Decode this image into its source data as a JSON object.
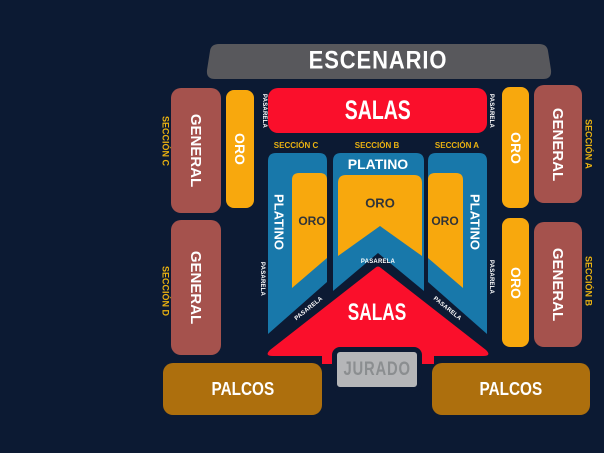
{
  "colors": {
    "background": "#0c1a33",
    "red": "#fa0f2b",
    "blue": "#1878aa",
    "gold": "#f8a80d",
    "maroon": "#a5524d",
    "brown": "#ad6f0d",
    "stage_gray": "#58585c",
    "jurado_gray": "#b5b6b8",
    "jurado_text": "#8b8e90",
    "section_label_gold": "#eab211",
    "oro_text_dark": "#313438",
    "white": "#ffffff"
  },
  "stage": {
    "label": "ESCENARIO"
  },
  "salas_top": {
    "label": "SALAS"
  },
  "section_headers": {
    "left": "SECCIÓN C",
    "center": "SECCIÓN B",
    "right": "SECCIÓN A"
  },
  "left_wing": {
    "general_top": {
      "label": "GENERAL",
      "section": "SECCIÓN C"
    },
    "general_bottom": {
      "label": "GENERAL",
      "section": "SECCIÓN D"
    },
    "oro": {
      "label": "ORO"
    },
    "pasarela_top": "PASARELA",
    "pasarela_bottom": "PASARELA"
  },
  "right_wing": {
    "general_top": {
      "label": "GENERAL",
      "section": "SECCIÓN A"
    },
    "general_bottom": {
      "label": "GENERAL",
      "section": "SECCIÓN B"
    },
    "oro_top": {
      "label": "ORO"
    },
    "oro_bottom": {
      "label": "ORO"
    },
    "pasarela_top": "PASARELA",
    "pasarela_bottom": "PASARELA"
  },
  "floor": {
    "platino_center": "PLATINO",
    "platino_left": "PLATINO",
    "platino_right": "PLATINO",
    "oro_center": "ORO",
    "oro_left": "ORO",
    "oro_right": "ORO",
    "pasarela_center": "PASARELA",
    "pasarela_diag_left": "PASARELA",
    "pasarela_diag_right": "PASARELA"
  },
  "bottom": {
    "salas": {
      "label": "SALAS"
    },
    "jurado": {
      "label": "JURADO"
    },
    "palcos_left": {
      "label": "PALCOS"
    },
    "palcos_right": {
      "label": "PALCOS"
    }
  }
}
